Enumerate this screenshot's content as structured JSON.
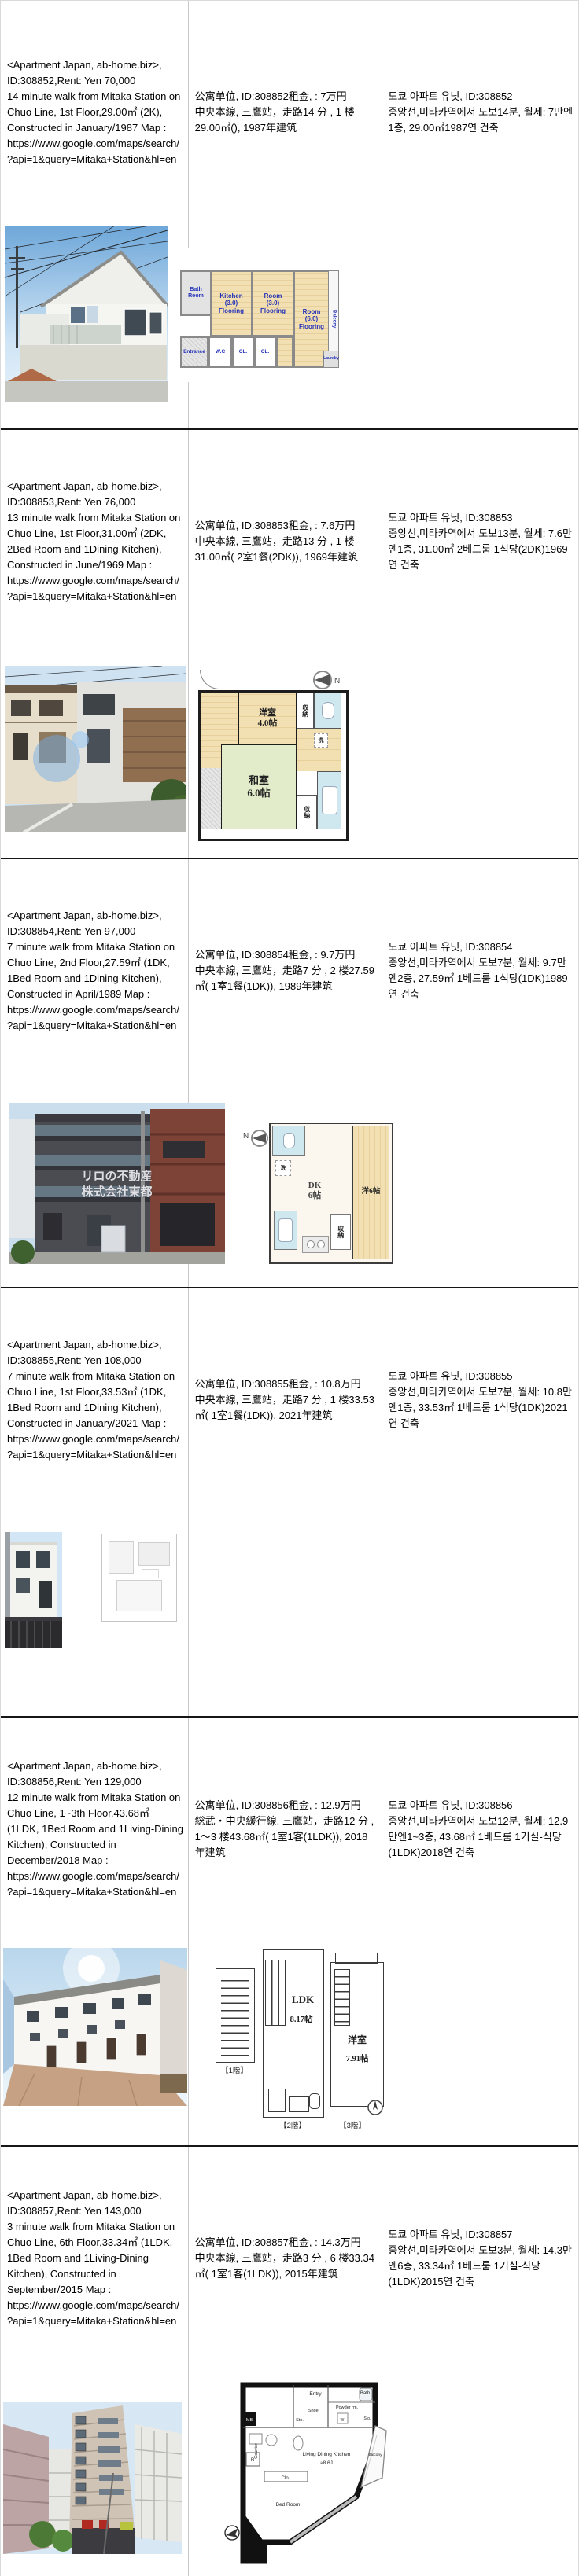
{
  "colors": {
    "plan_label_blue": "#2230b8",
    "wood_tan": "#f3e0b2",
    "tatami_green": "#e2ecca",
    "bath_blue": "#cfe8f0",
    "row_divider_black": "#161616",
    "column_divider_gray": "#c9c9c9"
  },
  "listings": [
    {
      "en": "<Apartment Japan, ab-home.biz>,\nID:308852,Rent: Yen 70,000\n14 minute walk from Mitaka Station on    Chuo Line, 1st Floor,29.00㎡ (2K), Constructed in January/1987 Map :\nhttps://www.google.com/maps/search/?api=1&query=Mitaka+Station&hl=en",
      "zh": "公寓单位, ID:308852租金, : 7万円\n中央本線, 三鷹站，走路14 分 , 1 楼29.00㎡(), 1987年建筑",
      "ko": "도쿄 아파트 유닛, ID:308852\n중앙선,미타카역에서 도보14분, 월세: 7만엔1층, 29.00㎡1987연 건축",
      "plan": {
        "bath": "Bath\nRoom",
        "kitchen": "Kitchen\n(3.0)\nFlooring",
        "room_a": "Room\n(3.0)\nFlooring",
        "room_b": "Room\n(6.0)\nFlooring",
        "balcony": "Balcony",
        "entrance": "Entrance",
        "wc": "W.C",
        "cl_a": "CL.",
        "cl_b": "CL.",
        "laundry": "Laundry"
      }
    },
    {
      "en": "<Apartment Japan, ab-home.biz>,\nID:308853,Rent: Yen 76,000\n13 minute walk from Mitaka Station on    Chuo Line, 1st Floor,31.00㎡ (2DK, 2Bed Room and 1Dining Kitchen), Constructed in June/1969 Map :\nhttps://www.google.com/maps/search/?api=1&query=Mitaka+Station&hl=en",
      "zh": "公寓单位, ID:308853租金, : 7.6万円\n中央本線, 三鷹站，走路13 分 , 1 楼31.00㎡( 2室1餐(2DK)), 1969年建筑",
      "ko": "도쿄 아파트 유닛, ID:308853\n중앙선,미타카역에서 도보13분, 월세: 7.6만엔1층, 31.00㎡ 2베드룸 1식당(2DK)1969연 건축",
      "plan": {
        "western_room": "洋室\n4.0帖",
        "tatami_room": "和室\n6.0帖",
        "closet_a": "収納",
        "closet_b": "収納",
        "wash": "洗",
        "north": "N"
      }
    },
    {
      "en": "<Apartment Japan, ab-home.biz>,\nID:308854,Rent: Yen 97,000\n7 minute walk from Mitaka Station on    Chuo Line, 2nd Floor,27.59㎡ (1DK, 1Bed Room and 1Dining Kitchen), Constructed in April/1989 Map :\nhttps://www.google.com/maps/search/?api=1&query=Mitaka+Station&hl=en",
      "zh": "公寓单位, ID:308854租金, : 9.7万円\n中央本線, 三鷹站，走路7 分 , 2 楼27.59㎡( 1室1餐(1DK)), 1989年建筑",
      "ko": "도쿄 아파트 유닛, ID:308854\n중앙선,미타카역에서 도보7분, 월세: 9.7만엔2층, 27.59㎡ 1베드룸 1식당(1DK)1989연 건축",
      "photo_watermark": "リロの不動産\n株式会社東都",
      "plan": {
        "dk": "DK\n6帖",
        "western_room": "洋6帖",
        "closet": "収納",
        "wash": "洗",
        "north": "N"
      }
    },
    {
      "en": "<Apartment Japan, ab-home.biz>,\nID:308855,Rent: Yen 108,000\n7 minute walk from Mitaka Station on    Chuo Line, 1st Floor,33.53㎡ (1DK, 1Bed Room and 1Dining Kitchen), Constructed in January/2021 Map :\nhttps://www.google.com/maps/search/?api=1&query=Mitaka+Station&hl=en",
      "zh": "公寓单位, ID:308855租金, : 10.8万円\n中央本線, 三鷹站，走路7 分 , 1 楼33.53㎡( 1室1餐(1DK)), 2021年建筑",
      "ko": "도쿄 아파트 유닛, ID:308855\n중앙선,미타카역에서 도보7분, 월세: 10.8만엔1층, 33.53㎡ 1베드룸 1식당(1DK)2021연 건축",
      "plan": {}
    },
    {
      "en": "<Apartment Japan, ab-home.biz>,\nID:308856,Rent: Yen 129,000\n12 minute walk from Mitaka Station on    Chuo Line, 1~3th Floor,43.68㎡ (1LDK, 1Bed Room and 1Living-Dining Kitchen), Constructed in December/2018 Map :\nhttps://www.google.com/maps/search/?api=1&query=Mitaka+Station&hl=en",
      "zh": "公寓单位, ID:308856租金, : 12.9万円\n総武・中央緩行線, 三鷹站，走路12 分 , 1～3 楼43.68㎡( 1室1客(1LDK)), 2018年建筑",
      "ko": "도쿄 아파트 유닛, ID:308856\n중앙선,미타카역에서 도보12분, 월세: 12.9만엔1~3층, 43.68㎡ 1베드룸 1거실-식당(1LDK)2018연 건축",
      "plan": {
        "floor1": "【1階】",
        "floor2": "【2階】",
        "floor3": "【3階】",
        "ldk": "LDK",
        "ldk_size": "8.17帖",
        "western_room": "洋室",
        "western_size": "7.91帖"
      }
    },
    {
      "en": "<Apartment Japan, ab-home.biz>,\nID:308857,Rent: Yen 143,000\n3 minute walk from Mitaka Station on    Chuo Line, 6th Floor,33.34㎡ (1LDK, 1Bed Room and 1Living-Dining Kitchen), Constructed in September/2015 Map :\nhttps://www.google.com/maps/search/?api=1&query=Mitaka+Station&hl=en",
      "zh": "公寓单位, ID:308857租金, : 14.3万円\n中央本線, 三鷹站，走路3 分 , 6 楼33.34㎡( 1室1客(1LDK)), 2015年建筑",
      "ko": "도쿄 아파트 유닛, ID:308857\n중앙선,미타카역에서 도보3분, 월세: 14.3만엔6층, 33.34㎡ 1베드룸 1거실-식당(1LDK)2015연 건축",
      "plan": {
        "entry": "Entry",
        "shoe": "Shoe.",
        "sto_a": "Sto.",
        "bath": "Bath",
        "powder": "Powder rm.",
        "sto_b": "Sto.",
        "w": "W",
        "mb": "MB",
        "counter": "Counter",
        "r": "R",
        "clo": "Clo.",
        "ldk": "Living Dining Kitchen",
        "ldk_size": "≈8.6J",
        "bedroom": "Bed Room",
        "balcony": "Balcony"
      }
    }
  ]
}
